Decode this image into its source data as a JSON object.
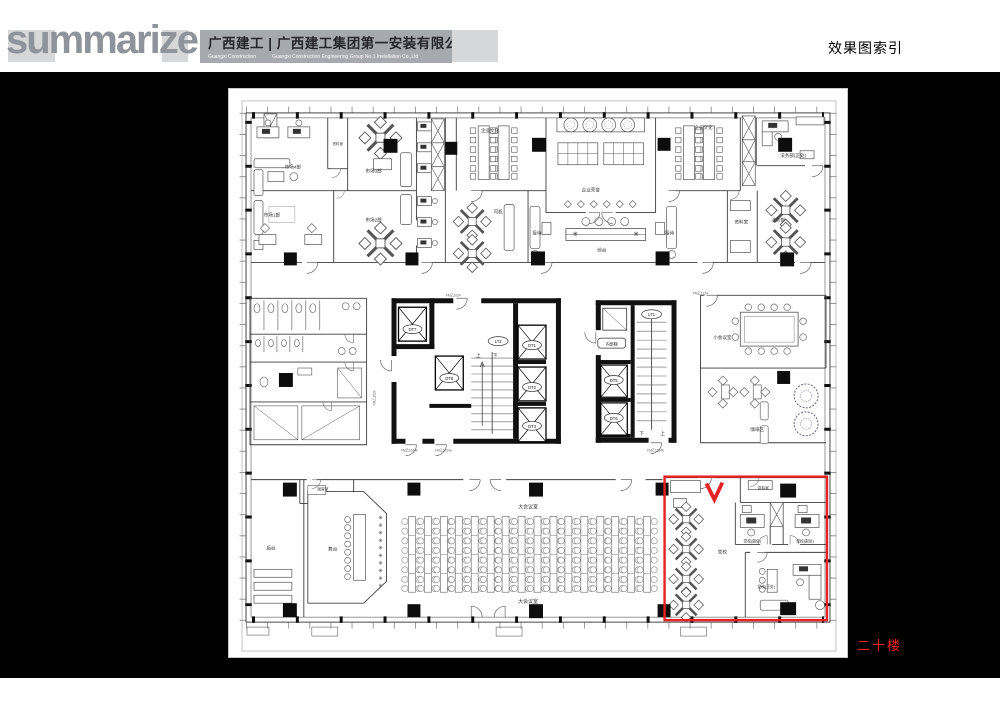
{
  "header": {
    "logo_text": "summarize",
    "company_cn": "广西建工 | 广西建工集团第一安装有限公司",
    "company_en_left": "Guangxi Construction",
    "company_en_right": "Guangxi Construction Engineering Group No.1 Installation Co.,Ltd",
    "page_title": "效果图索引"
  },
  "plan": {
    "floor_label": "二十楼",
    "highlight_color": "#e62222",
    "rooms": {
      "market4": "市场4部",
      "archive_top": "资料室",
      "market3": "市场3部",
      "market1": "市场1部",
      "market2": "市场2部",
      "driver": "司机",
      "culture_left": "企业文化",
      "honor": "企业荣誉",
      "culture_right": "企业文化",
      "lounge_left": "接待",
      "front_desk": "前台",
      "lounge_right": "接待",
      "archive_mid": "资料室",
      "legal_chief": "法务部(正处)",
      "legal_dept": "法务部",
      "small_meeting": "小会议室",
      "coffee": "咖啡区",
      "tuning": "调音室",
      "backstage": "后台",
      "stage": "舞台",
      "hall_top": "大会议室",
      "hall_bottom": "大会议室",
      "party_school": "党校",
      "archive_red": "资料室",
      "party_deputy_left": "党校(副处)",
      "party_deputy_right": "党校(副处)",
      "party_chief": "党校(正处)"
    },
    "core": {
      "dt1": "DT1",
      "dt2": "DT2",
      "dt3": "DT3",
      "dt5": "DT5",
      "dt6": "DT6",
      "dt7": "DT7",
      "dt8": "DT8",
      "lt1": "LT1",
      "lt2": "LT2",
      "internal_stair": "内部梯",
      "up": "上",
      "down": "下"
    },
    "fire_doors": {
      "fm1": "FM乙1024",
      "fm2": "FM乙1224",
      "fm3": "FM乙1024a",
      "fm4": "FM乙1024b",
      "fm5": "FM乙1224b"
    }
  }
}
